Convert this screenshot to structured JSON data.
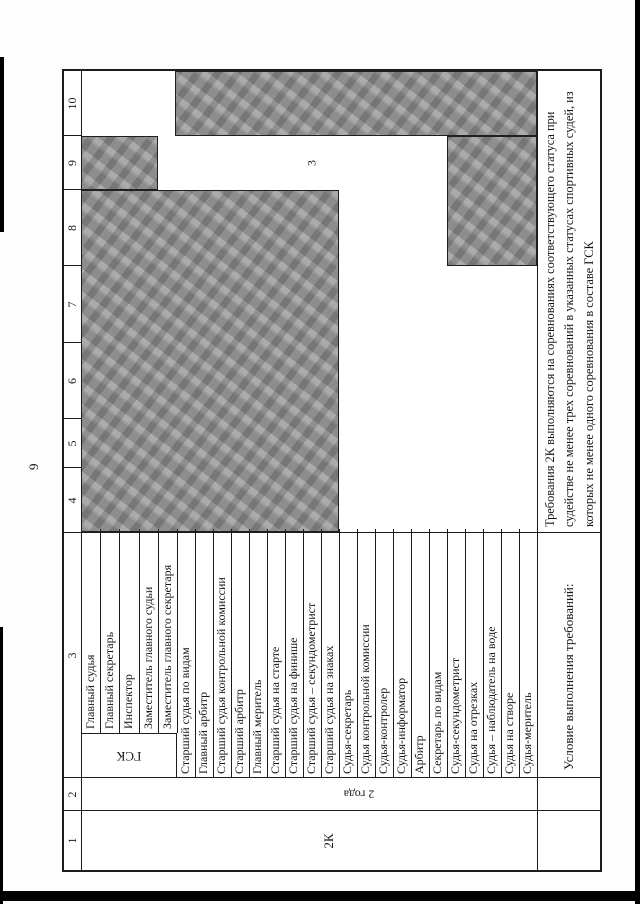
{
  "page_number": "9",
  "table": {
    "headers": [
      "1",
      "2",
      "3",
      "4",
      "5",
      "6",
      "7",
      "8",
      "9",
      "10"
    ],
    "category_label": "2К",
    "period_label": "2 года",
    "gsk_label": "ГСК",
    "officials": [
      "Главный судья",
      "Главный секретарь",
      "Инспектор",
      "Заместитель главного судьи",
      "Заместитель главного секретаря"
    ],
    "judges": [
      "Старший судья по видам",
      "Главный арбитр",
      "Старший судья контрольной комиссии",
      "Старший арбитр",
      "Главный меритель",
      "Старший судья на старте",
      "Старший судья на финише",
      "Старший судья – секундометрист",
      "Старший судья на знаках",
      "Судья-секретарь",
      "Судья контрольной комиссии",
      "Судья-контролер",
      "Судья-информатор",
      "Арбитр",
      "Секретарь по видам",
      "Судья-секундометрист",
      "Судья на отрезках",
      "Судья – наблюдатель на воде",
      "Судья на створе",
      "Судья-меритель"
    ],
    "cell_value": "3",
    "condition_label": "Условие выполнения требований:",
    "condition_text": "Требования 2К выполняются на соревнованиях соответствующего статуса при судействе не менее трех соревнований в указанных статусах спортивных судей, из которых не менее одного соревнования в составе ГСК"
  },
  "colors": {
    "shade": "#a2a2a2",
    "line": "#1c1c1c"
  }
}
